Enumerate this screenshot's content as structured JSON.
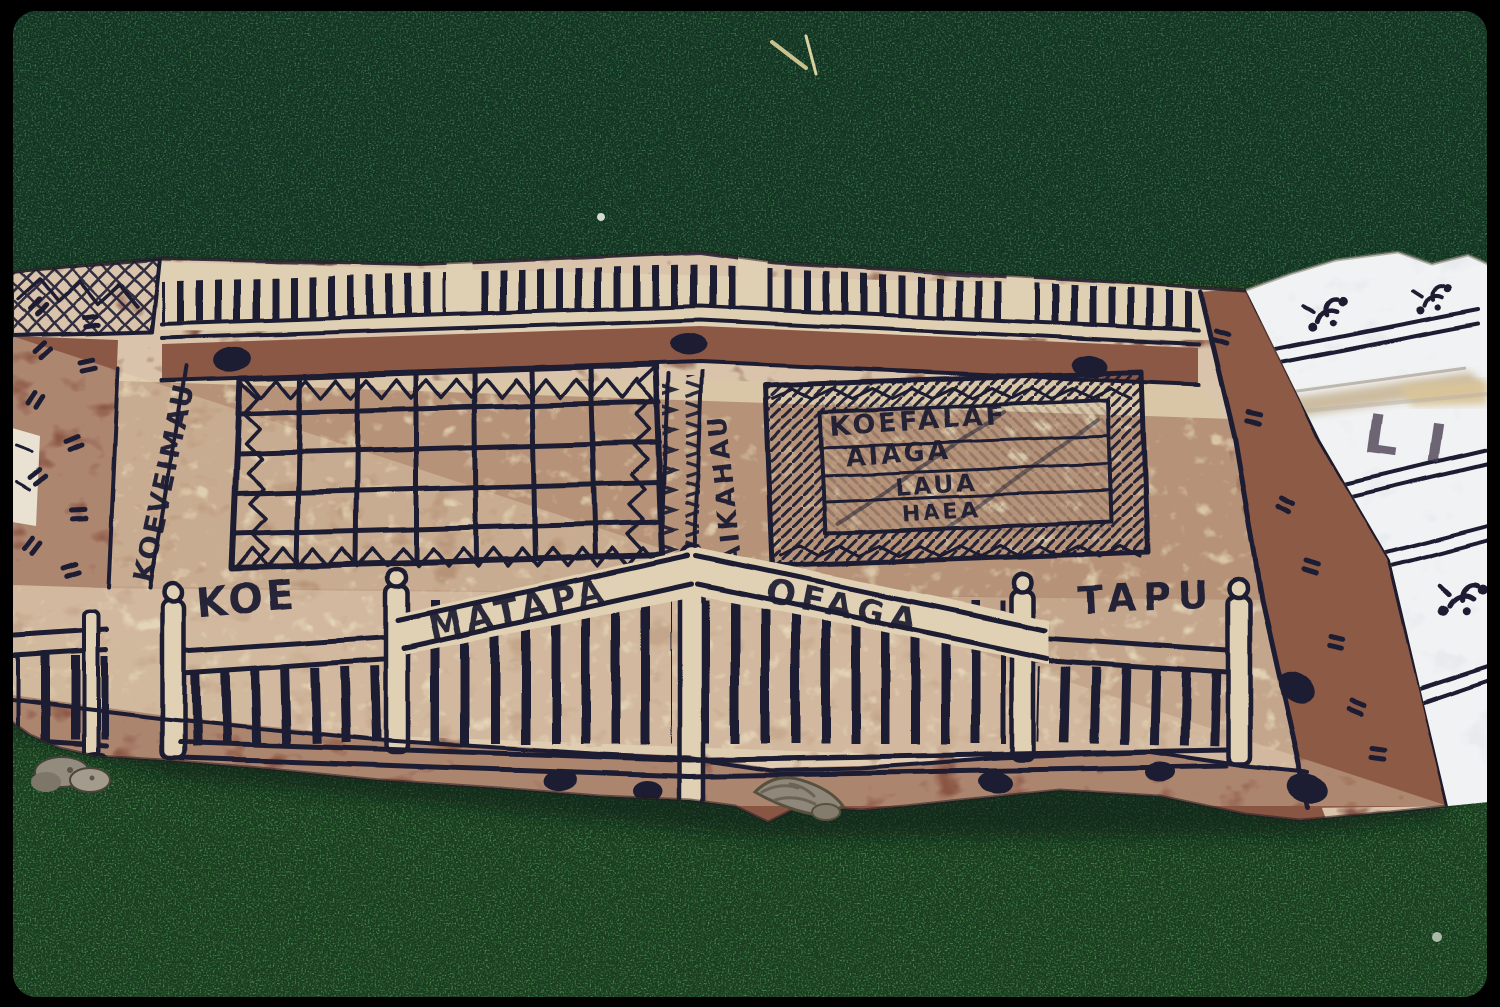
{
  "inscriptions": {
    "left_border_vertical": "KOEVEIMAU",
    "center_column_vertical": "TAIKAHAU",
    "plaque_lines": [
      "KOEFALAF",
      "AIAGA",
      "LAUA",
      "HAEA"
    ],
    "gate_words": [
      "KOE",
      "MATAPA",
      "OFAGA",
      "TAPU"
    ],
    "white_panel_letters": "LI"
  },
  "palette": {
    "ink": "#1d1d33",
    "bark_brown": "#8a5a49",
    "band_brown": "#8c5846",
    "cream": "#e3d4b8",
    "white_cloth": "#e8ebee",
    "grass_dark": "#2c5a3b",
    "grass_light": "#49854f",
    "film_border": "#000000",
    "pebble_grey": "#968f82"
  }
}
